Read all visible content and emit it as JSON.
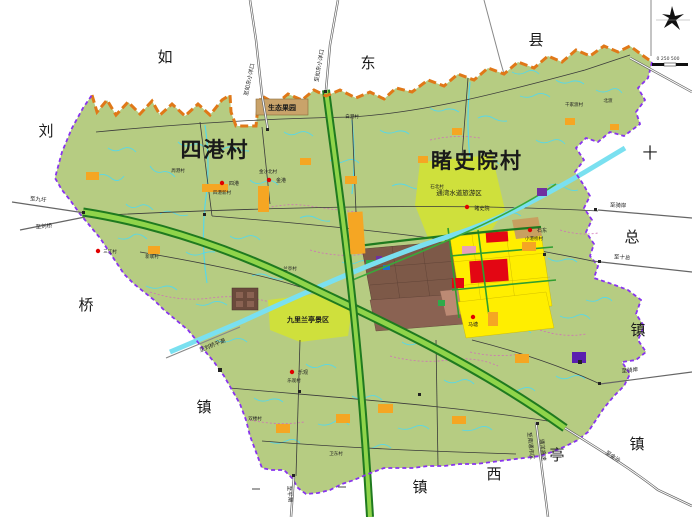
{
  "villages": [
    {
      "name": "四港村"
    },
    {
      "name": "睹史院村"
    }
  ],
  "neighbors": [
    {
      "text": "如"
    },
    {
      "text": "东"
    },
    {
      "text": "县"
    },
    {
      "text": "刘"
    },
    {
      "text": "十"
    },
    {
      "text": "总"
    },
    {
      "text": "桥"
    },
    {
      "text": "镇"
    },
    {
      "text": "镇"
    },
    {
      "text": "镇"
    },
    {
      "text": "西"
    },
    {
      "text": "亭"
    },
    {
      "text": "镇"
    }
  ],
  "areas": [
    {
      "name": "生态果园"
    },
    {
      "name": "九里兰亭景区"
    },
    {
      "name": "通湾水道旅游区"
    }
  ],
  "roads": [
    {
      "label": "至如东小洋口"
    },
    {
      "label": "至如东小洋口"
    },
    {
      "label": "至九圩"
    },
    {
      "label": "至刘桥"
    },
    {
      "label": "至骑岸"
    },
    {
      "label": "至十总"
    },
    {
      "label": "至骑岸"
    },
    {
      "label": "至刘桥平潮"
    },
    {
      "label": "至金沙"
    },
    {
      "label": "至南通市区"
    },
    {
      "label": "通洋高速"
    },
    {
      "label": "至平潮"
    }
  ],
  "settlements": [
    {
      "name": "四港"
    },
    {
      "name": "四港新村"
    },
    {
      "name": "金港"
    },
    {
      "name": "金沙北村"
    },
    {
      "name": "睹史院"
    },
    {
      "name": "石东"
    },
    {
      "name": "小港桥村"
    },
    {
      "name": "马塘"
    },
    {
      "name": "乐观"
    },
    {
      "name": "乐观村"
    },
    {
      "name": "三江村"
    }
  ],
  "hamlets": [
    {
      "name": "白港村"
    },
    {
      "name": "周港村"
    },
    {
      "name": "新联村"
    },
    {
      "name": "千家渡村"
    },
    {
      "name": "北渡"
    },
    {
      "name": "石北村"
    },
    {
      "name": "兰亭村"
    },
    {
      "name": "双楼村"
    },
    {
      "name": "卫东村"
    }
  ],
  "scale": {
    "text": "0 250 500"
  },
  "colors": {
    "territory": "#b6cc82",
    "scenic_green": "#cfe03c",
    "county_boundary_dash": "#e07818",
    "town_boundary_dash": "#8833ee",
    "expressway_outer": "#1f7a1f",
    "expressway_inner": "#8fd44a",
    "canal": "#7ae0f0",
    "existing_village_brown": "#7d5948",
    "planned_yellow": "#ffee00",
    "commercial_red": "#e30613",
    "village_point_orange": "#f5a623",
    "river_cyan": "#57d8e8",
    "path_pink": "#d070b8"
  }
}
